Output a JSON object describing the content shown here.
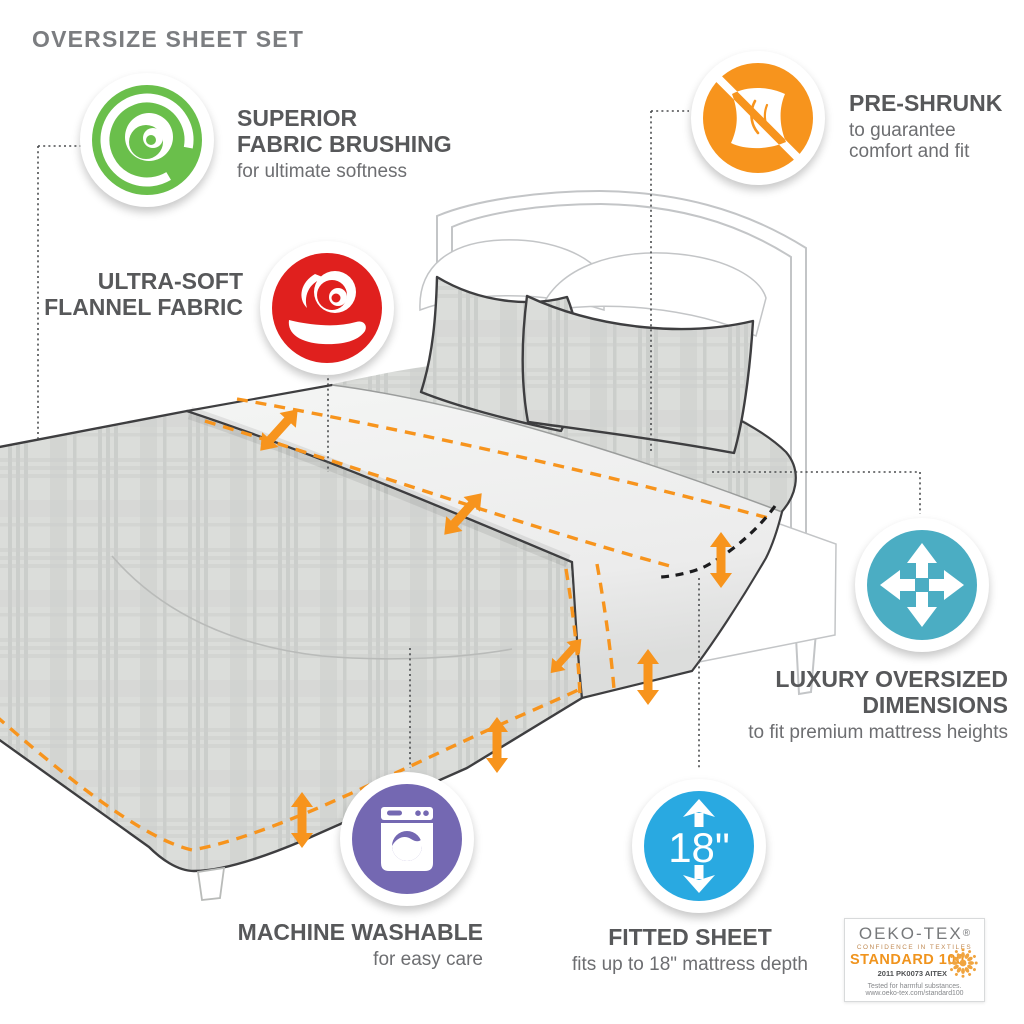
{
  "title": "OVERSIZE SHEET SET",
  "colors": {
    "heading_text": "#57585a",
    "caption_text": "#6d6e71",
    "title_text": "#7b7d80",
    "accent_orange": "#f7941d",
    "badge_green": "#6abf4b",
    "badge_red": "#e0201e",
    "badge_orange": "#f7941d",
    "badge_teal": "#4badc3",
    "badge_purple": "#7468b2",
    "badge_blue": "#29a9e1"
  },
  "features": [
    {
      "name": "superior-fabric-brushing",
      "heading_lines": [
        "SUPERIOR",
        "FABRIC BRUSHING"
      ],
      "caption_lines": [
        "for ultimate softness"
      ],
      "badge_color": "#6abf4b",
      "icon": "wave-swirl-icon"
    },
    {
      "name": "ultra-soft-flannel-fabric",
      "heading_lines": [
        "ULTRA-SOFT",
        "FLANNEL FABRIC"
      ],
      "caption_lines": [],
      "badge_color": "#e0201e",
      "icon": "hand-holding-fabric-icon"
    },
    {
      "name": "pre-shrunk",
      "heading_lines": [
        "PRE-SHRUNK"
      ],
      "caption_lines": [
        "to guarantee",
        "comfort and fit"
      ],
      "badge_color": "#f7941d",
      "icon": "no-shrink-fabric-icon"
    },
    {
      "name": "luxury-oversized-dimensions",
      "heading_lines": [
        "LUXURY OVERSIZED",
        "DIMENSIONS"
      ],
      "caption_lines": [
        "to fit premium mattress heights"
      ],
      "badge_color": "#4badc3",
      "icon": "expand-arrows-icon"
    },
    {
      "name": "machine-washable",
      "heading_lines": [
        "MACHINE WASHABLE"
      ],
      "caption_lines": [
        "for easy care"
      ],
      "badge_color": "#7468b2",
      "icon": "washing-machine-icon"
    },
    {
      "name": "fitted-sheet",
      "heading_lines": [
        "FITTED SHEET"
      ],
      "caption_lines": [
        "fits up to 18\" mattress depth"
      ],
      "badge_color": "#29a9e1",
      "icon": "mattress-depth-icon",
      "badge_text": "18\""
    }
  ],
  "certification": {
    "brand": "OEKO-TEX",
    "registered_mark": "®",
    "tagline": "CONFIDENCE IN TEXTILES",
    "standard": "STANDARD 100",
    "license": "2011 PK0073 AITEX",
    "tested_note": "Tested for harmful substances.",
    "url": "www.oeko-tex.com/standard100"
  }
}
